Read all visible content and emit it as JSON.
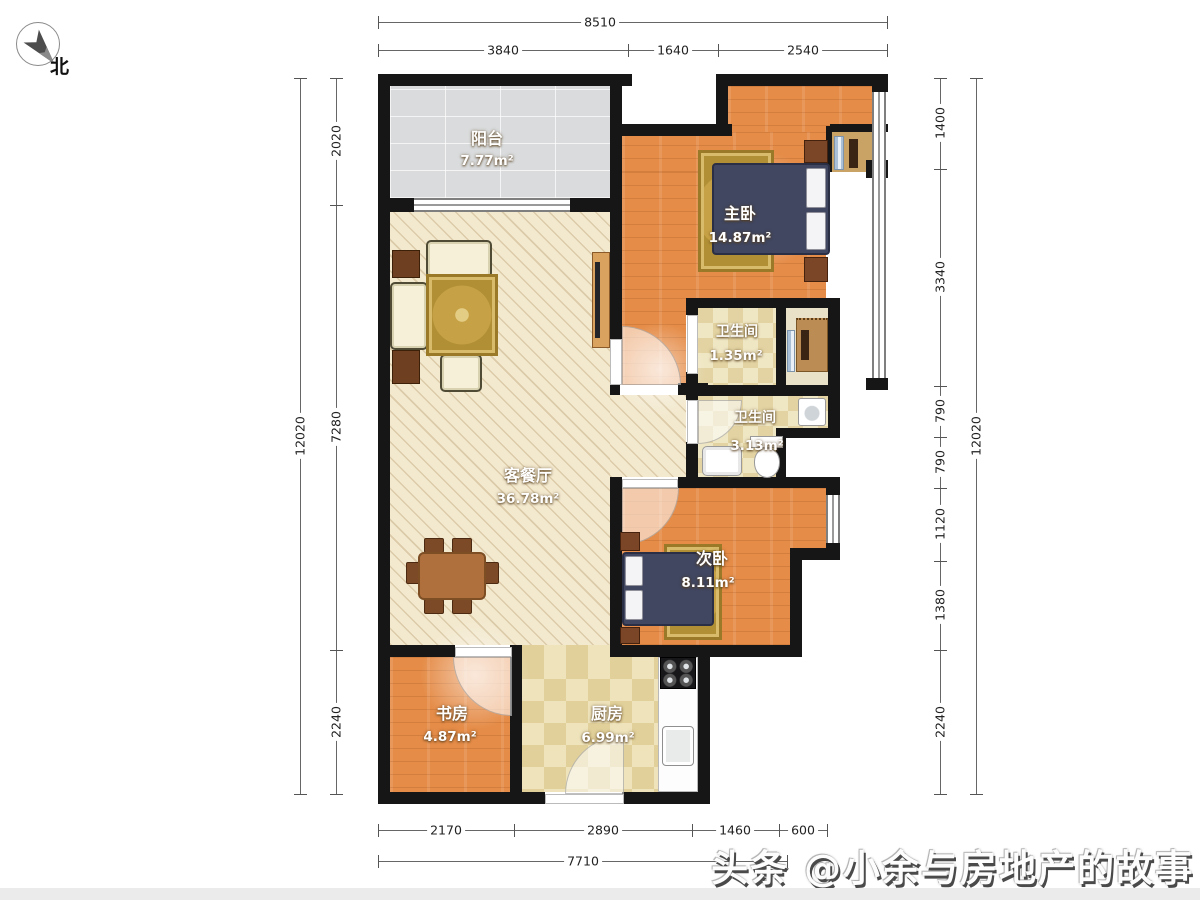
{
  "compass": {
    "label": "北"
  },
  "watermark": {
    "text": "头条 @小余与房地产的故事"
  },
  "rooms": {
    "balcony": {
      "name": "阳台",
      "area": "7.77m²"
    },
    "living": {
      "name": "客餐厅",
      "area": "36.78m²"
    },
    "master": {
      "name": "主卧",
      "area": "14.87m²"
    },
    "bath1": {
      "name": "卫生间",
      "area": "1.35m²"
    },
    "bath2": {
      "name": "卫生间",
      "area": "3.13m²"
    },
    "second": {
      "name": "次卧",
      "area": "8.11m²"
    },
    "study": {
      "name": "书房",
      "area": "4.87m²"
    },
    "kitchen": {
      "name": "厨房",
      "area": "6.99m²"
    }
  },
  "dimensions": {
    "top": {
      "total": "8510",
      "segments": [
        "3840",
        "1640",
        "2540"
      ]
    },
    "bottom": {
      "total": "7710",
      "segments": [
        "2170",
        "2890",
        "1460",
        "600"
      ]
    },
    "left": {
      "total": "12020",
      "segments": [
        "2020",
        "7280",
        "2240"
      ]
    },
    "right": {
      "total": "12020",
      "segments": [
        "1400",
        "3340",
        "790",
        "790",
        "1120",
        "1380",
        "2240"
      ]
    }
  },
  "colors": {
    "wall": "#161616",
    "wood_floor": "#e58c48",
    "living_floor": "#f3e9cf",
    "balcony_tile": "#d9dbdc",
    "kitchen_tile": "#eee3bb",
    "bed": "#414760",
    "rug": "#c7a145"
  }
}
